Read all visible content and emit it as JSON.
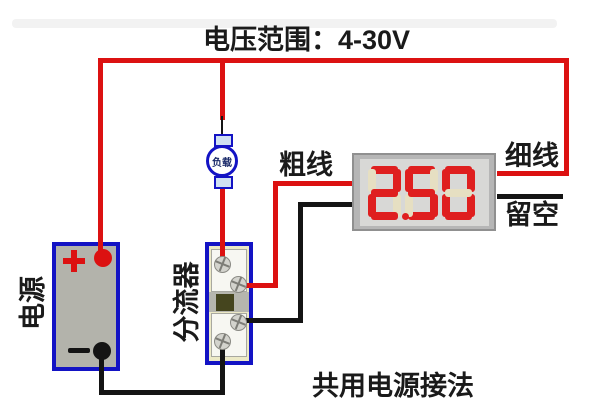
{
  "diagram": {
    "title": "电压范围：4-30V",
    "caption": "共用电源接法",
    "labels": {
      "power": "电源",
      "load": "负载",
      "shunt": "分流器",
      "thick_wire": "粗线",
      "thin_wire": "细线",
      "leave_empty": "留空",
      "plus_terminal": "+",
      "minus_terminal": "−"
    },
    "display": {
      "value": "2.50",
      "digits": [
        "2",
        "5",
        "0"
      ],
      "decimal_after_digit": 1
    },
    "colors": {
      "wire_positive": "#dc1111",
      "wire_negative": "#141414",
      "component_outline": "#1313c4",
      "segment_lit": "#df1f1f",
      "segment_unlit": "#e6dfc2",
      "battery_body": "#b3b3ab",
      "shunt_body": "#ece9c6",
      "display_frame": "#b6b6b6",
      "display_screen": "#d8d8d6"
    }
  }
}
